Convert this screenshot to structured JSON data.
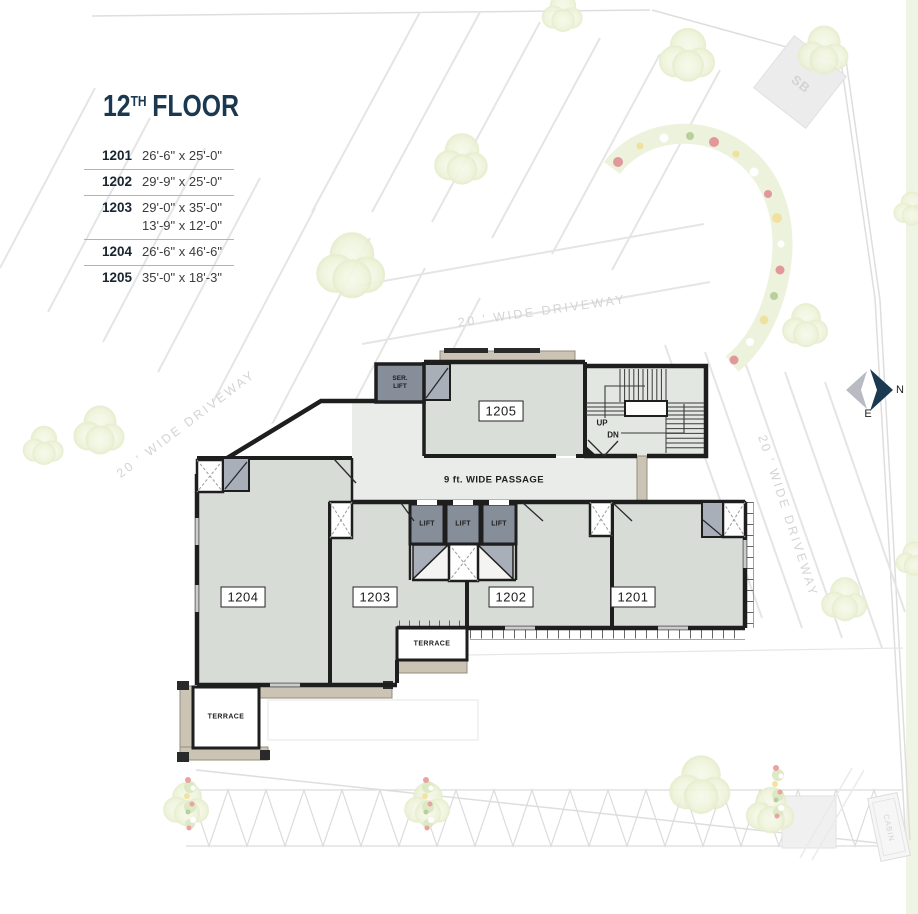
{
  "title": {
    "number": "12",
    "suffix": "TH",
    "word": "FLOOR"
  },
  "legend": {
    "rows": [
      {
        "unit": "1201",
        "dims": [
          "26'-6\" x 25'-0\""
        ]
      },
      {
        "unit": "1202",
        "dims": [
          "29'-9\" x 25'-0\""
        ]
      },
      {
        "unit": "1203",
        "dims": [
          "29'-0\" x 35'-0\"",
          "13'-9\" x 12'-0\""
        ]
      },
      {
        "unit": "1204",
        "dims": [
          "26'-6\" x 46'-6\""
        ]
      },
      {
        "unit": "1205",
        "dims": [
          "35'-0\" x 18'-3\""
        ]
      }
    ]
  },
  "plan": {
    "units": {
      "u1201": "1201",
      "u1202": "1202",
      "u1203": "1203",
      "u1204": "1204",
      "u1205": "1205"
    },
    "labels": {
      "passage": "9 ft. WIDE PASSAGE",
      "ser_lift": "SER.\nLIFT",
      "lift": "LIFT",
      "up": "UP",
      "dn": "DN",
      "terrace": "TERRACE"
    }
  },
  "site": {
    "driveway": "20 ' WIDE DRIVEWAY",
    "sb": "SB",
    "cabin": "CABIN"
  },
  "compass": {
    "north": "N",
    "east": "E"
  },
  "colors": {
    "accent_navy": "#1a3850",
    "room_fill": "#d7dcd7",
    "passage_fill": "#e9ece8",
    "lift_gray": "#868e9a",
    "gray2": "#a9afb9",
    "beige": "#cbc3b4",
    "wall": "#1e1e1e",
    "site_line": "#e3e3e3",
    "tree": "#edf2da"
  }
}
